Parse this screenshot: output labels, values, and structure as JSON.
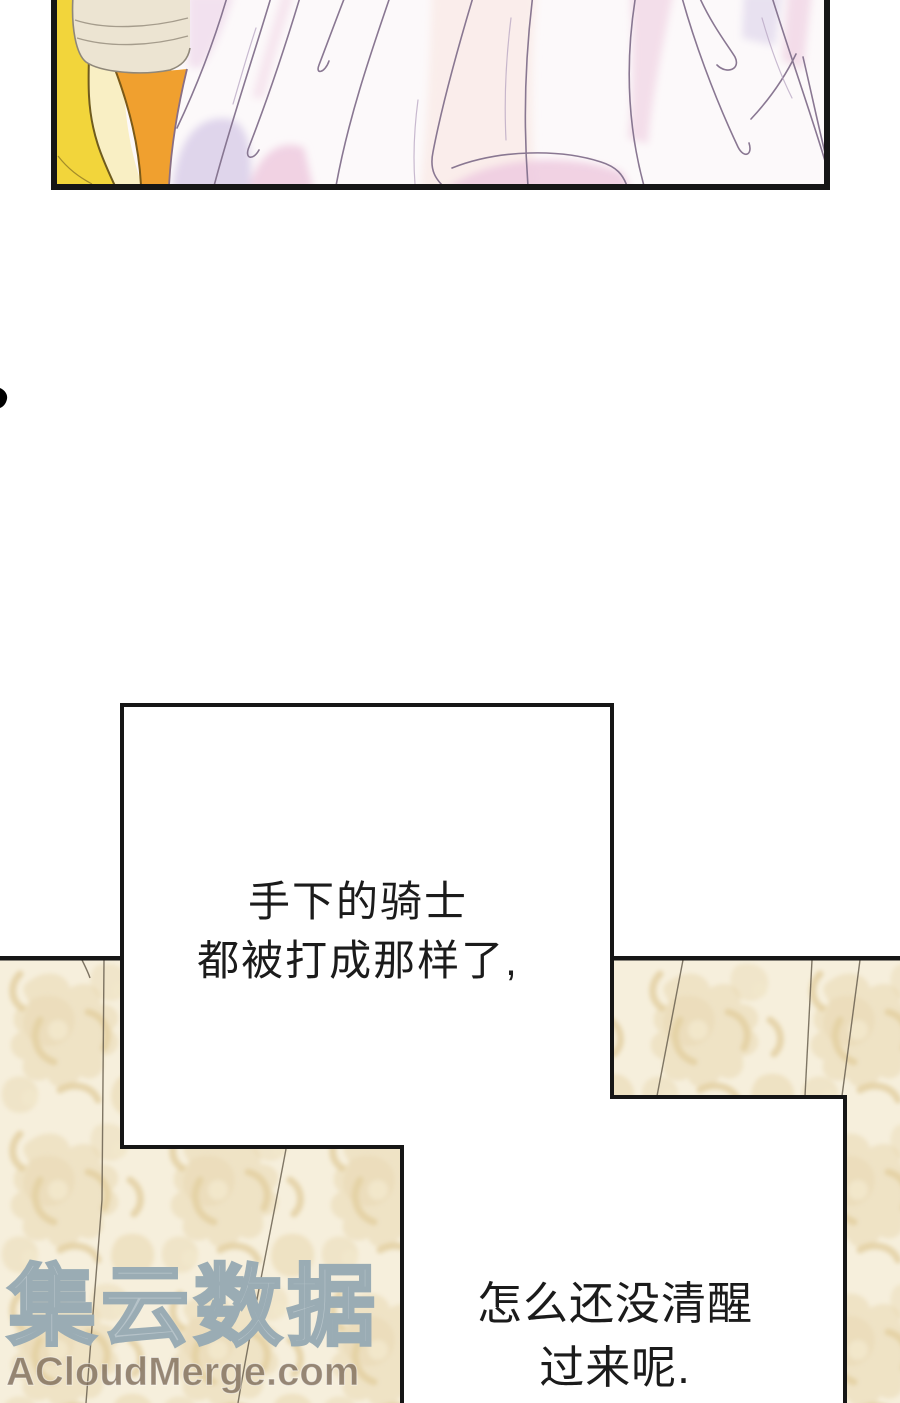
{
  "page": {
    "background": "#ffffff"
  },
  "speech_bubbles": {
    "bubble_a": {
      "lines": [
        "手下的骑士",
        "都被打成那样了,"
      ]
    },
    "bubble_b": {
      "lines": [
        "怎么还没清醒",
        "过来呢."
      ]
    }
  },
  "watermark": {
    "cjk": "集云数据",
    "latin": "ACloudMerge.com"
  },
  "colors": {
    "panel_border": "#161616",
    "wallpaper_base": "#f6efdc",
    "wallpaper_motif": "#e9d9b3",
    "dress_pink": "#f1d7e6",
    "dress_lavender": "#dbd0ea",
    "chair_yellow": "#f2d53b",
    "cushion_orange": "#f0a02f",
    "pouf_cream": "#ece4d2",
    "watermark_outline": "#9aacb4",
    "watermark_latin_color": "#806f5d"
  }
}
